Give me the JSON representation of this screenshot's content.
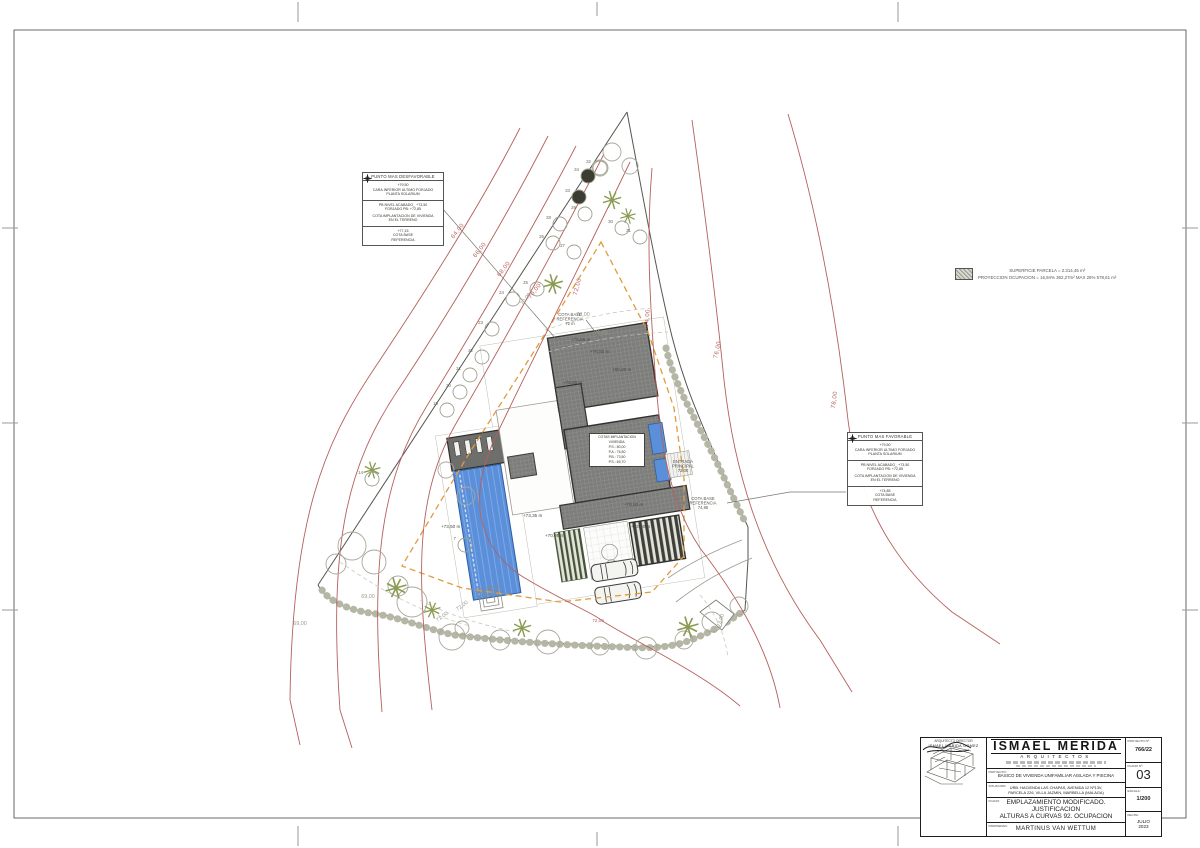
{
  "drawing": {
    "legend": {
      "line1": "SUPERFICIE PARCELA = 2.314,45 m²",
      "line2": "PROYECCION OCUPACION = 16,94% 392,27m² MAX 25% 578,61 m²"
    },
    "compass_glyph": "✦",
    "boxes": {
      "unfavorable": {
        "title": "PUNTO MAS DESFAVORABLE",
        "row1": [
          "+79,50",
          "CARA INFERIOR ULTIMO FORJADO",
          "PLANTA SOLARIUM"
        ],
        "row2": [
          "PB NIVEL ACABADO_ +73,50",
          "FORJADO PB: +72,85",
          "COTA IMPLANTACION DE VIVIENDA",
          "EN EL TERRENO"
        ],
        "row3": [
          "+77,15",
          "COTA BASE",
          "REFERENCIA"
        ]
      },
      "favorable": {
        "title": "PUNTO MAS FAVORABLE",
        "row1": [
          "+79,50",
          "CARA INFERIOR ULTIMO FORJADO",
          "PLANTA SOLARIUM"
        ],
        "row2": [
          "PB NIVEL ACABADO_ +73,50",
          "FORJADO PB: +72,85",
          "COTA IMPLANTACION DE VIVIENDA",
          "EN EL TERRENO"
        ],
        "row3": [
          "+74,85",
          "COTA BASE",
          "REFERENCIA"
        ]
      }
    },
    "info_box": {
      "title1": "COTAS IMPLANTACION",
      "title2": "VIVIENDA:",
      "levels": [
        "P.S.: 80,00",
        "P.A.: 76,50",
        "P.B.: 73,50",
        "P.S.: 69,70"
      ]
    },
    "contour_labels": [
      {
        "t": "64,00",
        "x": 459,
        "y": 232,
        "r": -52,
        "c": "red"
      },
      {
        "t": "66,00",
        "x": 481,
        "y": 251,
        "r": -52,
        "c": "red"
      },
      {
        "t": "68,00",
        "x": 505,
        "y": 270,
        "r": -52,
        "c": "red"
      },
      {
        "t": "70,00",
        "x": 536,
        "y": 292,
        "r": -52,
        "c": "red"
      },
      {
        "t": "72,00",
        "x": 579,
        "y": 287,
        "r": -75,
        "c": "red"
      },
      {
        "t": "74,00",
        "x": 649,
        "y": 318,
        "r": -85,
        "c": "red"
      },
      {
        "t": "76,00",
        "x": 719,
        "y": 350,
        "r": -78,
        "c": "red"
      },
      {
        "t": "78,00",
        "x": 836,
        "y": 400,
        "r": -82,
        "c": "red"
      },
      {
        "t": "72,00",
        "x": 598,
        "y": 622,
        "r": 0,
        "c": "redS"
      },
      {
        "t": "70,00",
        "x": 583,
        "y": 316,
        "r": 0,
        "c": "gray"
      },
      {
        "t": "71,00",
        "x": 601,
        "y": 334,
        "r": 0,
        "c": "gray"
      },
      {
        "t": "69,00",
        "x": 368,
        "y": 598,
        "r": 0,
        "c": "gray"
      },
      {
        "t": "71,00",
        "x": 443,
        "y": 618,
        "r": -38,
        "c": "gray"
      },
      {
        "t": "72,00",
        "x": 463,
        "y": 607,
        "r": -38,
        "c": "gray"
      },
      {
        "t": "73,00",
        "x": 722,
        "y": 621,
        "r": -70,
        "c": "gray"
      },
      {
        "t": "70,00",
        "x": 527,
        "y": 300,
        "r": -52,
        "c": "gray"
      },
      {
        "t": "69,00",
        "x": 300,
        "y": 625,
        "r": 0,
        "c": "gray"
      }
    ],
    "level_labels": [
      {
        "t": "+75,65 m",
        "x": 571,
        "y": 341
      },
      {
        "t": "+76,50 m",
        "x": 590,
        "y": 353
      },
      {
        "t": "+76,50 m",
        "x": 563,
        "y": 384
      },
      {
        "t": "+80,00 m",
        "x": 612,
        "y": 371
      },
      {
        "t": "+76,50 m",
        "x": 624,
        "y": 506
      },
      {
        "t": "+73,50 m",
        "x": 631,
        "y": 528
      },
      {
        "t": "+73,50 m",
        "x": 441,
        "y": 528
      },
      {
        "t": "+73,35 m",
        "x": 523,
        "y": 517
      },
      {
        "t": "+70,95 m",
        "x": 545,
        "y": 537
      }
    ],
    "note_labels": [
      {
        "lines": [
          "COTA BASE",
          "REFERENCIA",
          "72 m"
        ],
        "x": 570,
        "y": 316
      },
      {
        "lines": [
          "ENTRADA",
          "PRINCIPAL",
          "72,00"
        ],
        "x": 683,
        "y": 463
      },
      {
        "lines": [
          "COTA BASE",
          "REFERENCIA",
          "74,85"
        ],
        "x": 703,
        "y": 500
      }
    ],
    "trees": [
      {
        "n": "19",
        "x": 447,
        "y": 410
      },
      {
        "n": "20",
        "x": 460,
        "y": 392
      },
      {
        "n": "21",
        "x": 470,
        "y": 375
      },
      {
        "n": "22",
        "x": 482,
        "y": 357
      },
      {
        "n": "23",
        "x": 492,
        "y": 329
      },
      {
        "n": "24",
        "x": 513,
        "y": 299
      },
      {
        "n": "25",
        "x": 537,
        "y": 289
      },
      {
        "n": "26",
        "x": 553,
        "y": 243
      },
      {
        "n": "27",
        "x": 574,
        "y": 252
      },
      {
        "n": "28",
        "x": 560,
        "y": 224
      },
      {
        "n": "29",
        "x": 585,
        "y": 214
      },
      {
        "n": "30",
        "x": 622,
        "y": 228
      },
      {
        "n": "31",
        "x": 640,
        "y": 237
      },
      {
        "n": "32",
        "x": 600,
        "y": 168
      },
      {
        "n": "33",
        "x": 579,
        "y": 197,
        "f": true
      },
      {
        "n": "34",
        "x": 588,
        "y": 176,
        "f": true
      },
      {
        "n": "14",
        "x": 372,
        "y": 479
      },
      {
        "n": "7",
        "x": 465,
        "y": 545
      }
    ]
  },
  "title_block": {
    "logo": "ISMAEL MERIDA",
    "logo_sub": "ARQUITECTOS",
    "director_label": "ARQUITECTO DIRECTOR",
    "director_name": "ISMAEL MERIDA GOMEZ",
    "fields": [
      {
        "label": "PROYECTO:",
        "value": "BASICO DE VIVIENDA UNIFAMILIAR AISLADA Y PISCINA"
      },
      {
        "label": "SITUACION:",
        "value1": "URB. HACIENDA LAS CHAPAS, AVENIDA 12 Nº13V,",
        "value2": "PARCELA 226, VILLA JAZMIN, MARBELLA (MALAGA)"
      },
      {
        "label": "PLANO:",
        "value1": "EMPLAZAMIENTO MODIFICADO. JUSTIFICACION",
        "value2": "ALTURAS A CURVAS 92. OCUPACION"
      },
      {
        "label": "PROPIEDAD:",
        "value": "MARTINUS VAN WETTUM"
      }
    ],
    "meta": [
      {
        "label": "PROYECTO Nº:",
        "value": "766/22"
      },
      {
        "label": "PLANO Nº:",
        "value": "03"
      },
      {
        "label": "ESCALA:",
        "value": "1/200"
      },
      {
        "label": "FECHA:",
        "value1": "JULIO",
        "value2": "2023"
      }
    ]
  }
}
